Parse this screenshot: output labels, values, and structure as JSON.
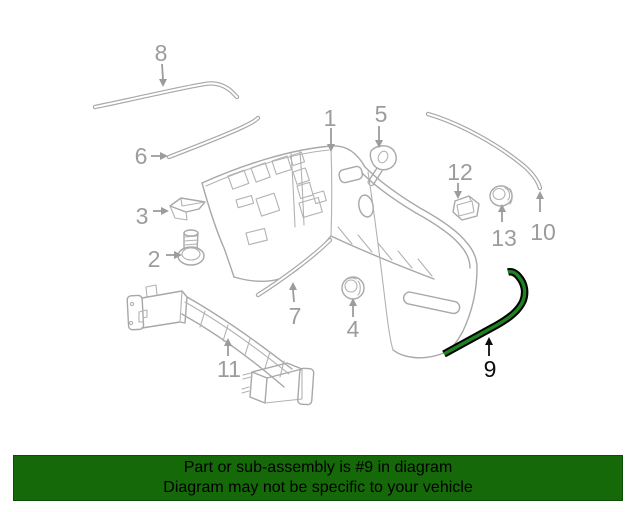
{
  "diagram": {
    "description": "Exploded rear bumper assembly parts diagram",
    "highlighted_part": "9",
    "line_color": "#a8a8a8",
    "callout_color": "#9c9c9c",
    "highlight_outline_color": "#000000",
    "highlight_fill_color": "#1e821e",
    "callouts": [
      {
        "label": "1"
      },
      {
        "label": "2"
      },
      {
        "label": "3"
      },
      {
        "label": "4"
      },
      {
        "label": "5"
      },
      {
        "label": "6"
      },
      {
        "label": "7"
      },
      {
        "label": "8"
      },
      {
        "label": "9"
      },
      {
        "label": "10"
      },
      {
        "label": "11"
      },
      {
        "label": "12"
      },
      {
        "label": "13"
      }
    ]
  },
  "banner": {
    "line1": "Part or sub-assembly is #9 in diagram",
    "line2": "Diagram may not be specific to your vehicle",
    "background_color": "#156908",
    "text_color": "#000000"
  }
}
